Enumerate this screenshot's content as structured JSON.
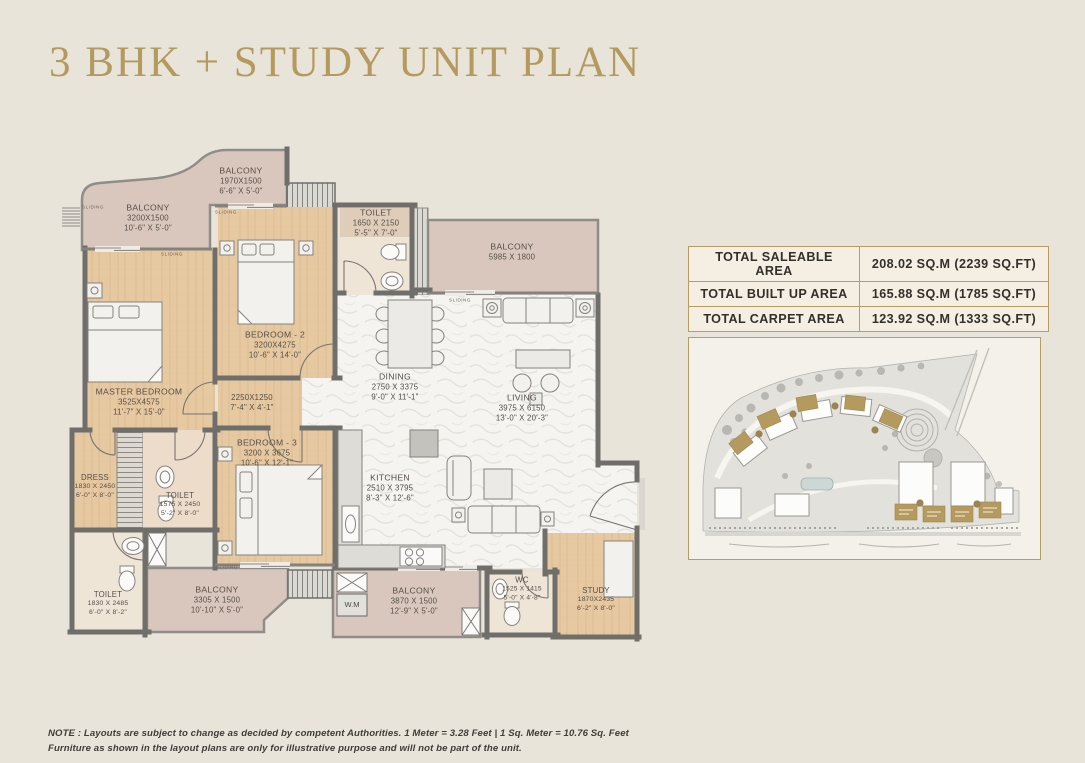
{
  "header": {
    "title": "3 BHK + STUDY UNIT PLAN"
  },
  "area_table": {
    "rows": [
      {
        "label": "TOTAL SALEABLE AREA",
        "value": "208.02 SQ.M (2239 SQ.FT)"
      },
      {
        "label": "TOTAL BUILT UP AREA",
        "value": "165.88 SQ.M (1785 SQ.FT)"
      },
      {
        "label": "TOTAL CARPET AREA",
        "value": "123.92 SQ.M (1333 SQ.FT)"
      }
    ]
  },
  "floor_plan": {
    "rooms": {
      "balcony_master": {
        "name": "BALCONY",
        "mm": "3200X1500",
        "ft": "10'-6\" X 5'-0\""
      },
      "balcony_top": {
        "name": "BALCONY",
        "mm": "1970X1500",
        "ft": "6'-6\" X 5'-0\""
      },
      "toilet_top": {
        "name": "TOILET",
        "mm": "1650 X 2150",
        "ft": "5'-5\" X 7'-0\""
      },
      "balcony_living": {
        "name": "BALCONY",
        "mm": "5985 X 1800",
        "ft": ""
      },
      "bedroom2": {
        "name": "BEDROOM - 2",
        "mm": "3200X4275",
        "ft": "10'-6\" X 14'-0\""
      },
      "master_bedroom": {
        "name": "MASTER BEDROOM",
        "mm": "3525X4575",
        "ft": "11'-7\" X 15'-0\""
      },
      "passage": {
        "name": "",
        "mm": "2250X1250",
        "ft": "7'-4\" X 4'-1\""
      },
      "bedroom3": {
        "name": "BEDROOM - 3",
        "mm": "3200 X 3675",
        "ft": "10'-6\" X 12'-1\""
      },
      "dining": {
        "name": "DINING",
        "mm": "2750 X 3375",
        "ft": "9'-0\" X 11'-1\""
      },
      "living": {
        "name": "LIVING",
        "mm": "3975 X 6150",
        "ft": "13'-0\" X 20'-3\""
      },
      "kitchen": {
        "name": "KITCHEN",
        "mm": "2510 X 3795",
        "ft": "8'-3\" X 12'-6\""
      },
      "dress": {
        "name": "DRESS",
        "mm": "1830 X 2450",
        "ft": "6'-0\" X 8'-0\""
      },
      "toilet_master": {
        "name": "TOILET",
        "mm": "1575 X 2450",
        "ft": "5'-2\" X 8'-0\""
      },
      "toilet_left": {
        "name": "TOILET",
        "mm": "1830 X 2485",
        "ft": "6'-0\" X 8'-2\""
      },
      "balcony_b3": {
        "name": "BALCONY",
        "mm": "3305 X 1500",
        "ft": "10'-10\" X 5'-0\""
      },
      "balcony_kitchen": {
        "name": "BALCONY",
        "mm": "3870 X 1500",
        "ft": "12'-9\" X 5'-0\""
      },
      "wc": {
        "name": "WC",
        "mm": "1525 X 1415",
        "ft": "5'-0\" X 4'-8\""
      },
      "study": {
        "name": "STUDY",
        "mm": "1870X2435",
        "ft": "6'-2\" X 8'-0\""
      }
    },
    "labels": {
      "wm": "W.M",
      "sliding": "SLIDING"
    }
  },
  "note": {
    "line1": "NOTE : Layouts are subject to change as decided by competent Authorities. 1 Meter = 3.28 Feet | 1 Sq. Meter = 10.76 Sq. Feet",
    "line2": "Furniture as shown in the layout plans are only for illustrative purpose and will not be part of the unit."
  },
  "colors": {
    "accent_gold": "#b49a5e",
    "wall_gray": "#6f6e6a",
    "wood_floor": "#e6c8a1",
    "balcony_mauve": "#d9c7be",
    "tile_cream": "#efe5d7",
    "marble_white": "#f5f4f1",
    "page_background": "#e8e4da"
  }
}
